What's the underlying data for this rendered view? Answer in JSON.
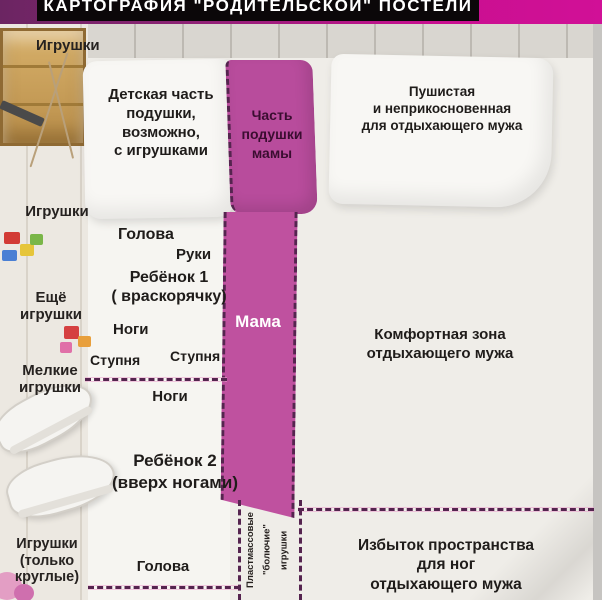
{
  "title": "КАРТОГРАФИЯ \"РОДИТЕЛЬСКОЙ\" ПОСТЕЛИ",
  "colors": {
    "band_magenta": "#c90f90",
    "strip_pink": "#bf519f",
    "dash_purple": "#55244f",
    "bed_white": "#efede8"
  },
  "left_rail": {
    "labels": [
      {
        "text": "Игрушки"
      },
      {
        "text": "Игрушки"
      },
      {
        "text": "Ещё\nигрушки"
      },
      {
        "text": "Мелкие\nигрушки"
      },
      {
        "text": "Игрушки\n(только\nкруглые)"
      }
    ]
  },
  "pillows": {
    "child": "Детская часть\nподушки,\nвозможно,\nс игрушками",
    "mom": "Часть\nподушки\nмамы",
    "husband": "Пушистая\nи неприкосновенная\nдля отдыхающего мужа"
  },
  "zones": {
    "child1": {
      "head": "Голова",
      "hands": "Руки",
      "name": "Ребёнок 1\n( враскорячку)",
      "legs": "Ноги",
      "foot_left": "Ступня",
      "foot_right": "Ступня"
    },
    "mom_strip": "Мама",
    "husband_comfort": "Комфортная зона\nотдыхающего мужа",
    "child2": {
      "legs": "Ноги",
      "name": "Ребёнок 2\n(вверх ногами)",
      "head": "Голова"
    },
    "plastic_toys": "Пластмассовые\n\"болючие\"\nигрушки",
    "husband_feet": "Избыток пространства\nдля ног\nотдыхающего мужа"
  }
}
